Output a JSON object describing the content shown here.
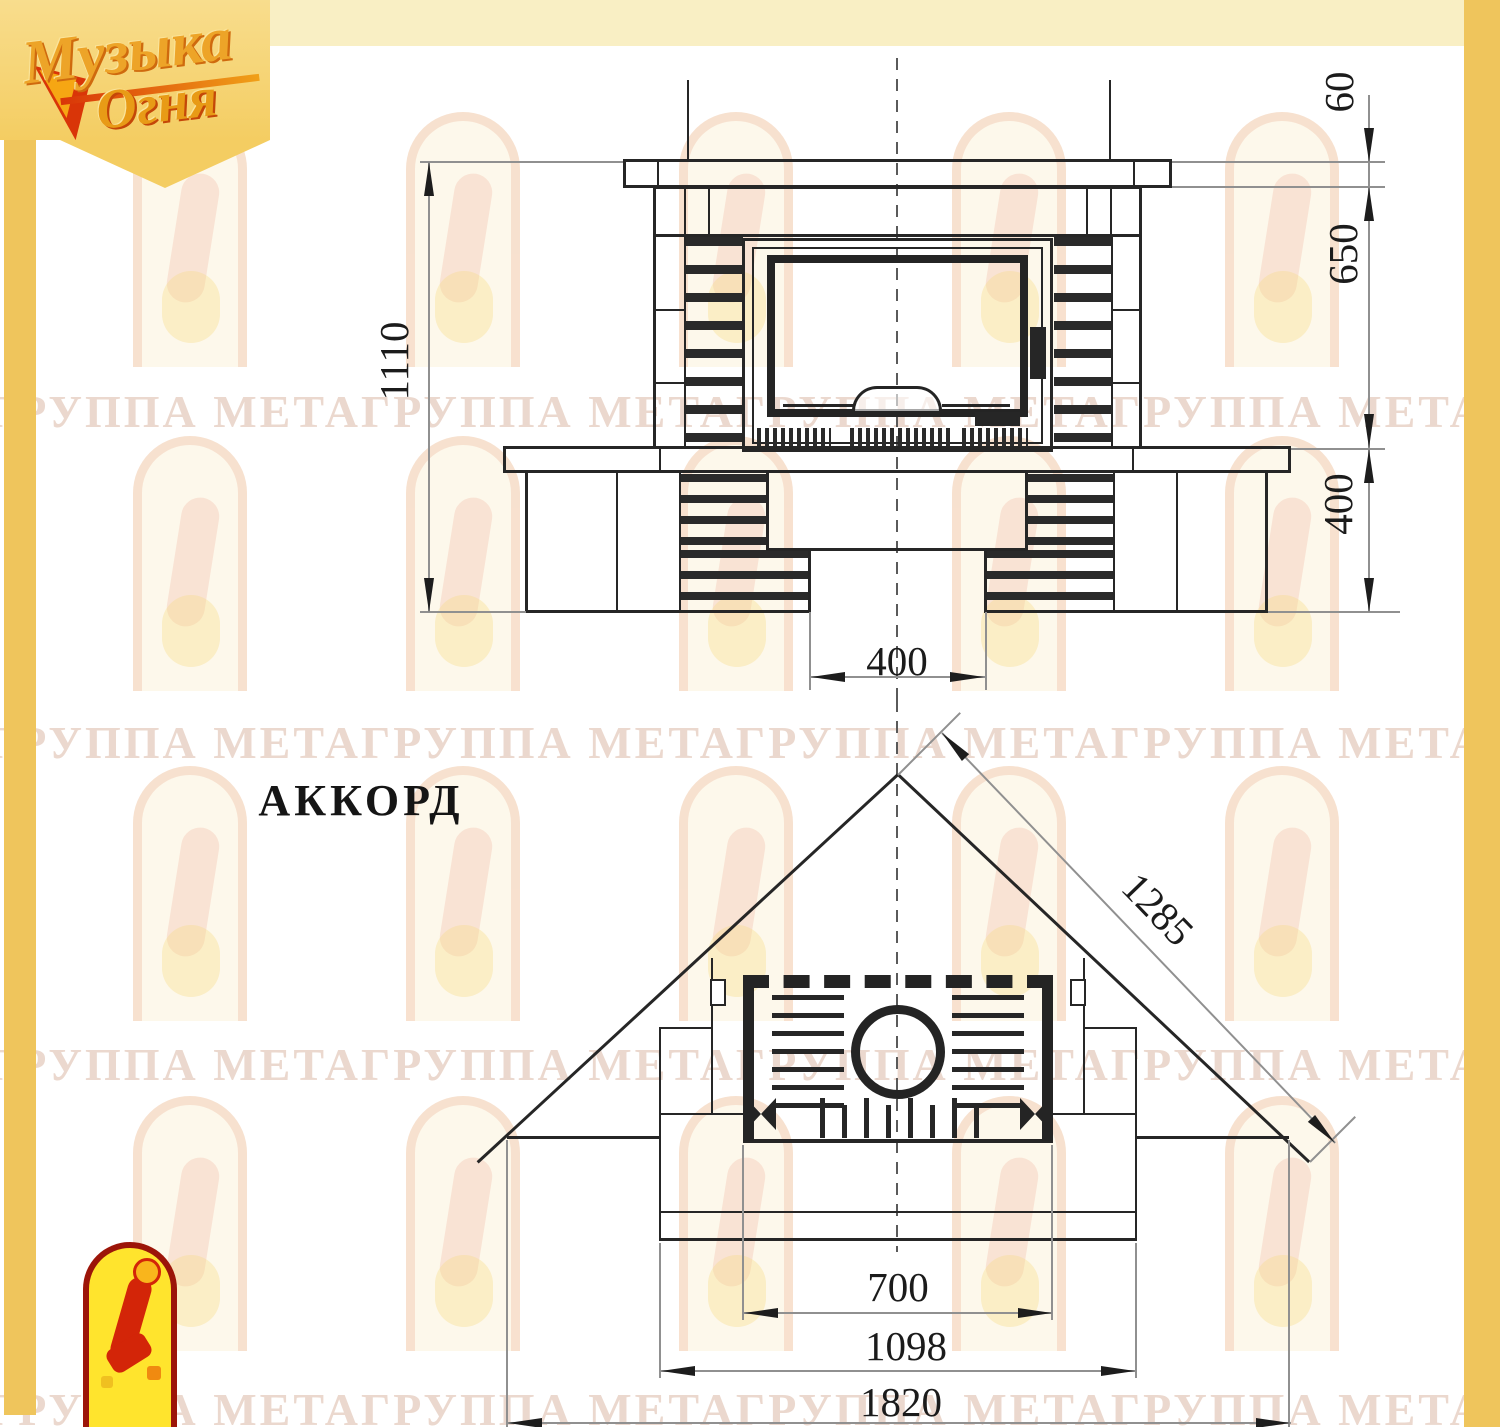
{
  "page": {
    "background": "#ffffff",
    "gold_strip_color": "#efc55c",
    "line_color": "#262626"
  },
  "logo": {
    "word1": "Музыка",
    "word2": "Огня"
  },
  "watermark": {
    "text": "ГРУППА МЕТАГРУППА МЕТАГРУППА МЕТАГРУППА МЕТАГРУППА МЕТА"
  },
  "drawing": {
    "title": "АККОРД",
    "front_view": {
      "dim_total_height": "1110",
      "dim_shelf_thickness": "60",
      "dim_body_height": "650",
      "dim_base_height": "400",
      "dim_recess_width": "400"
    },
    "plan_view": {
      "dim_diagonal_width": "1285",
      "dim_opening_width": "700",
      "dim_front_width": "1098",
      "dim_overall_width": "1820"
    }
  }
}
